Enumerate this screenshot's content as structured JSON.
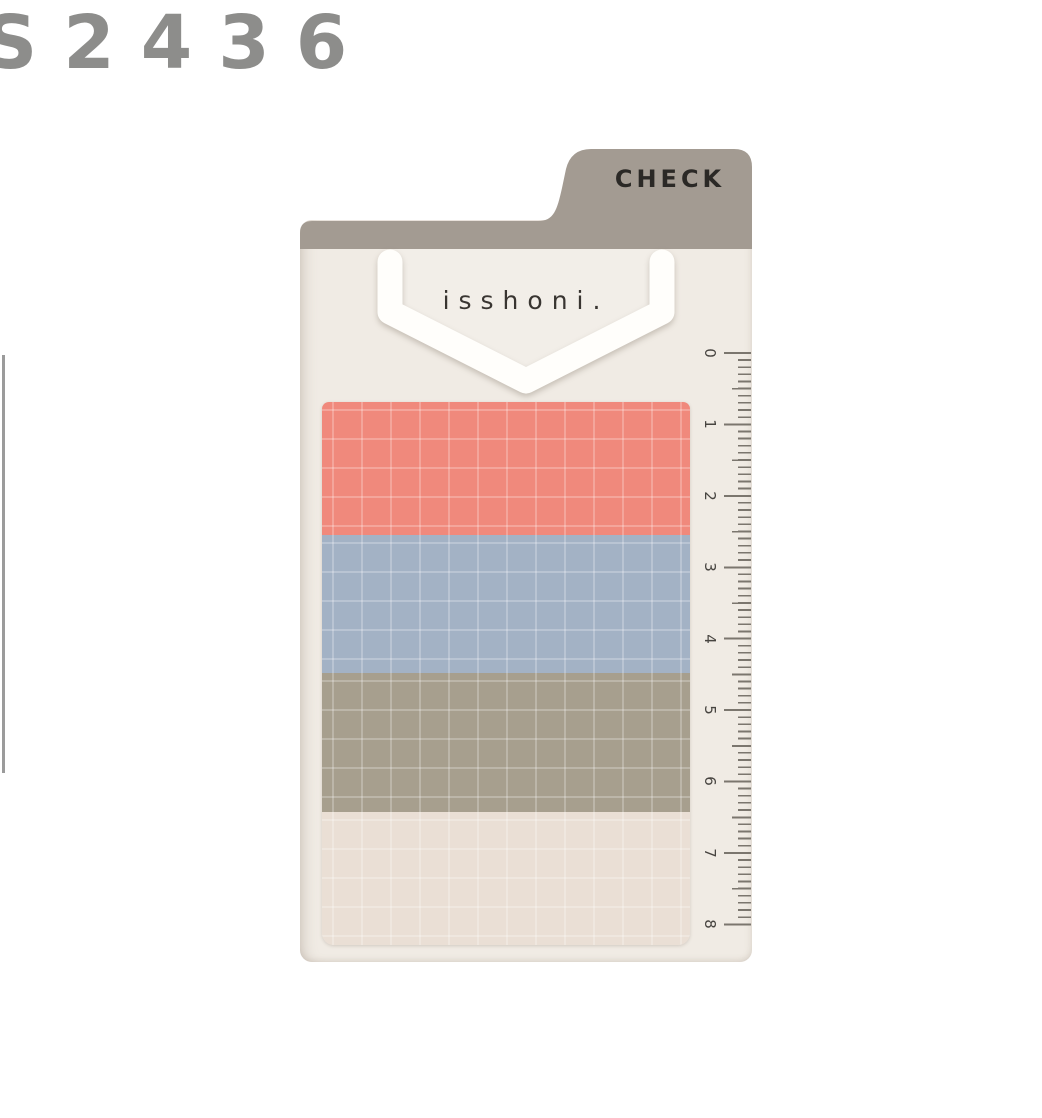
{
  "photo": {
    "product_code": "S2436",
    "background": "#ffffff"
  },
  "product": {
    "tab_label": "CHECK",
    "brand": "isshoni.",
    "pads": [
      {
        "name": "coral-grid-note",
        "color": "#f0897c"
      },
      {
        "name": "blue-gray-grid-note",
        "color": "#a3b2c5"
      },
      {
        "name": "taupe-grid-note",
        "color": "#a79f8e"
      },
      {
        "name": "cream-grid-note",
        "color": "#eadfd5"
      }
    ],
    "ruler": {
      "numbers": [
        "0",
        "1",
        "2",
        "3",
        "4",
        "5",
        "6",
        "7",
        "8"
      ],
      "mark_color": "#7b766e",
      "number_color": "#474440"
    },
    "colors": {
      "card": "#f0ebe4",
      "tab": "#a39b92",
      "tab_text": "#2b2926",
      "clip": "#fffefb",
      "clip_inner": "#f2eee8",
      "brand_text": "#393531",
      "grid_line": "rgba(255,255,255,0.25)",
      "code_text": "#8d8d8b",
      "left_line": "#9b9b9b"
    }
  }
}
